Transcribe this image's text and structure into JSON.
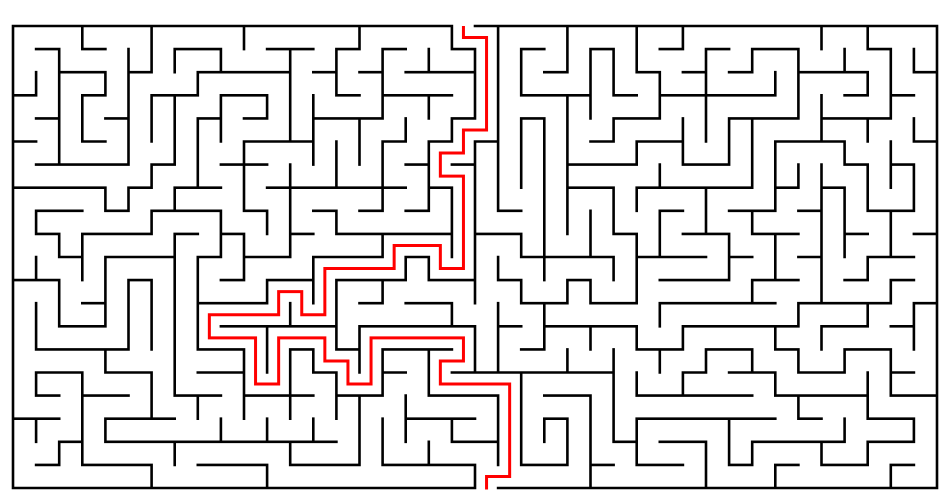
{
  "canvas": {
    "width": 951,
    "height": 500,
    "background_color": "#ffffff"
  },
  "maze": {
    "cols": 40,
    "rows": 20,
    "origin_x": 13,
    "origin_y": 26,
    "cell_size": 23.1,
    "wall_color": "#000000",
    "wall_stroke_width": 2.6,
    "entry": {
      "side": "top",
      "col": 19
    },
    "exit": {
      "side": "bottom",
      "col": 20
    },
    "random_seed": 20240613,
    "solution_path": {
      "color": "#ff0000",
      "stroke_width": 3,
      "waypoints_col_row": [
        [
          19,
          0
        ],
        [
          20,
          0
        ],
        [
          20,
          4
        ],
        [
          19,
          4
        ],
        [
          19,
          5
        ],
        [
          18,
          5
        ],
        [
          18,
          6
        ],
        [
          19,
          6
        ],
        [
          19,
          10
        ],
        [
          18,
          10
        ],
        [
          18,
          9
        ],
        [
          16,
          9
        ],
        [
          16,
          10
        ],
        [
          13,
          10
        ],
        [
          13,
          12
        ],
        [
          12,
          12
        ],
        [
          12,
          11
        ],
        [
          11,
          11
        ],
        [
          11,
          12
        ],
        [
          8,
          12
        ],
        [
          8,
          13
        ],
        [
          10,
          13
        ],
        [
          10,
          15
        ],
        [
          11,
          15
        ],
        [
          11,
          13
        ],
        [
          13,
          13
        ],
        [
          13,
          14
        ],
        [
          14,
          14
        ],
        [
          14,
          15
        ],
        [
          15,
          15
        ],
        [
          15,
          13
        ],
        [
          19,
          13
        ],
        [
          19,
          14
        ],
        [
          18,
          14
        ],
        [
          18,
          15
        ],
        [
          21,
          15
        ],
        [
          21,
          19
        ],
        [
          20,
          19
        ]
      ]
    }
  }
}
